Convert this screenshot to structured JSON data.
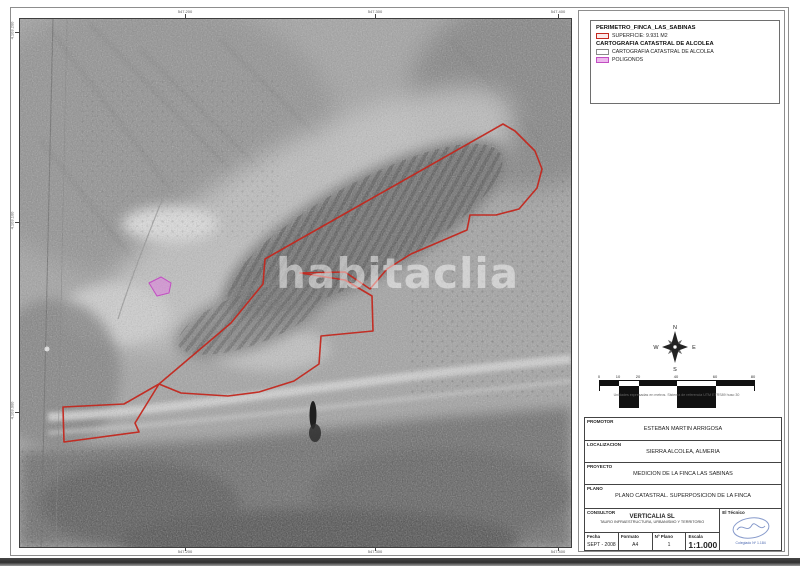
{
  "map": {
    "watermark": "habitaclia",
    "x_ticks": [
      "547.200",
      "547.300",
      "547.400"
    ],
    "y_ticks": [
      "4.103.200",
      "4.103.100",
      "4.103.000"
    ]
  },
  "legend": {
    "title1": "PERIMETRO_FINCA_LAS_SABINAS",
    "superficie": "SUPERFICIE: 9.931 M2",
    "title2": "CARTOGRAFIA CATASTRAL DE ALCOLEA",
    "catastral": "CARTOGRAFIA CATASTRAL DE ALCOLEA",
    "poligonos": "POLIGONOS"
  },
  "compass": {
    "n": "N",
    "e": "E",
    "s": "S",
    "w": "W"
  },
  "scalebar": {
    "ticks": [
      "0",
      "10",
      "20",
      "40",
      "60",
      "80"
    ],
    "note": "Unidades expresadas en metros. Sistema de referencia UTM ETRS89 huso 30"
  },
  "titleblock": {
    "promotor_label": "PROMOTOR",
    "promotor_value": "ESTEBAN MARTIN ARRIGOSA",
    "localizacion_label": "LOCALIZACION",
    "localizacion_value": "SIERRA ALCOLEA, ALMERIA",
    "proyecto_label": "PROYECTO",
    "proyecto_value": "MEDICION DE LA FINCA LAS SABINAS",
    "plano_label": "PLANO",
    "plano_value": "PLANO CATASTRAL. SUPERPOSICION DE LA FINCA",
    "consultor_label": "CONSULTOR",
    "consultor_name": "VERTICALIA SL",
    "consultor_sub": "TAURO INFRAESTRUCTURA, URBANISMO Y TERRITORIO",
    "tecnico_label": "El Técnico",
    "tecnico_sub": "Colegiado Nº 1.184",
    "fecha_label": "Fecha",
    "fecha_value": "SEPT - 2008",
    "formato_label": "Formato",
    "formato_value": "A4",
    "nplano_label": "Nº Plano",
    "nplano_value": "1",
    "escala_label": "Escala",
    "escala_value": "1:1.000"
  },
  "colors": {
    "perimeter_red": "#c3271e",
    "poligonos_pink": "#c24ec2",
    "stamp_blue": "#4a67b0"
  }
}
